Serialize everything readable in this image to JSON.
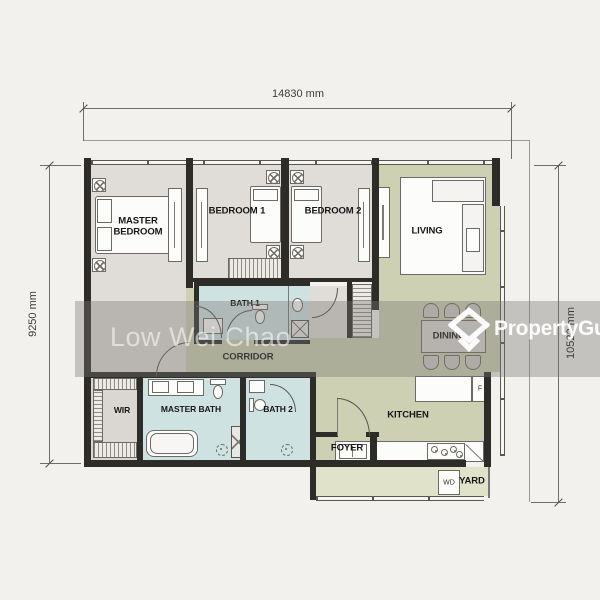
{
  "dimensions": {
    "top": "14830 mm",
    "left": "9250 mm",
    "right": "10522 mm"
  },
  "rooms": {
    "master_bedroom": "MASTER BEDROOM",
    "bedroom1": "BEDROOM 1",
    "bedroom2": "BEDROOM 2",
    "living": "LIVING",
    "dining": "DINING",
    "corridor": "CORRIDOR",
    "bath1": "BATH 1",
    "wir": "WIR",
    "master_bath": "MASTER BATH",
    "bath2": "BATH 2",
    "foyer": "FOYER",
    "kitchen": "KITCHEN",
    "yard": "YARD"
  },
  "appliances": {
    "fridge": "F",
    "washer_dryer": "WD"
  },
  "watermark": {
    "agent_name": "Low Wei Chao"
  },
  "brand": {
    "name": "PropertyGuru",
    "icon": "propertyguru-house-icon"
  },
  "colors": {
    "background": "#f2f1ee",
    "wall": "#2d2c29",
    "floor_bedroom": "#e0dcd7",
    "floor_living_green": "#cdd0b2",
    "floor_yard_green": "#e0e3c9",
    "floor_bath_blue": "#cfe2e2",
    "floor_wir_grey": "#dad7d3",
    "watermark_band": "rgba(120,119,116,0.38)"
  }
}
